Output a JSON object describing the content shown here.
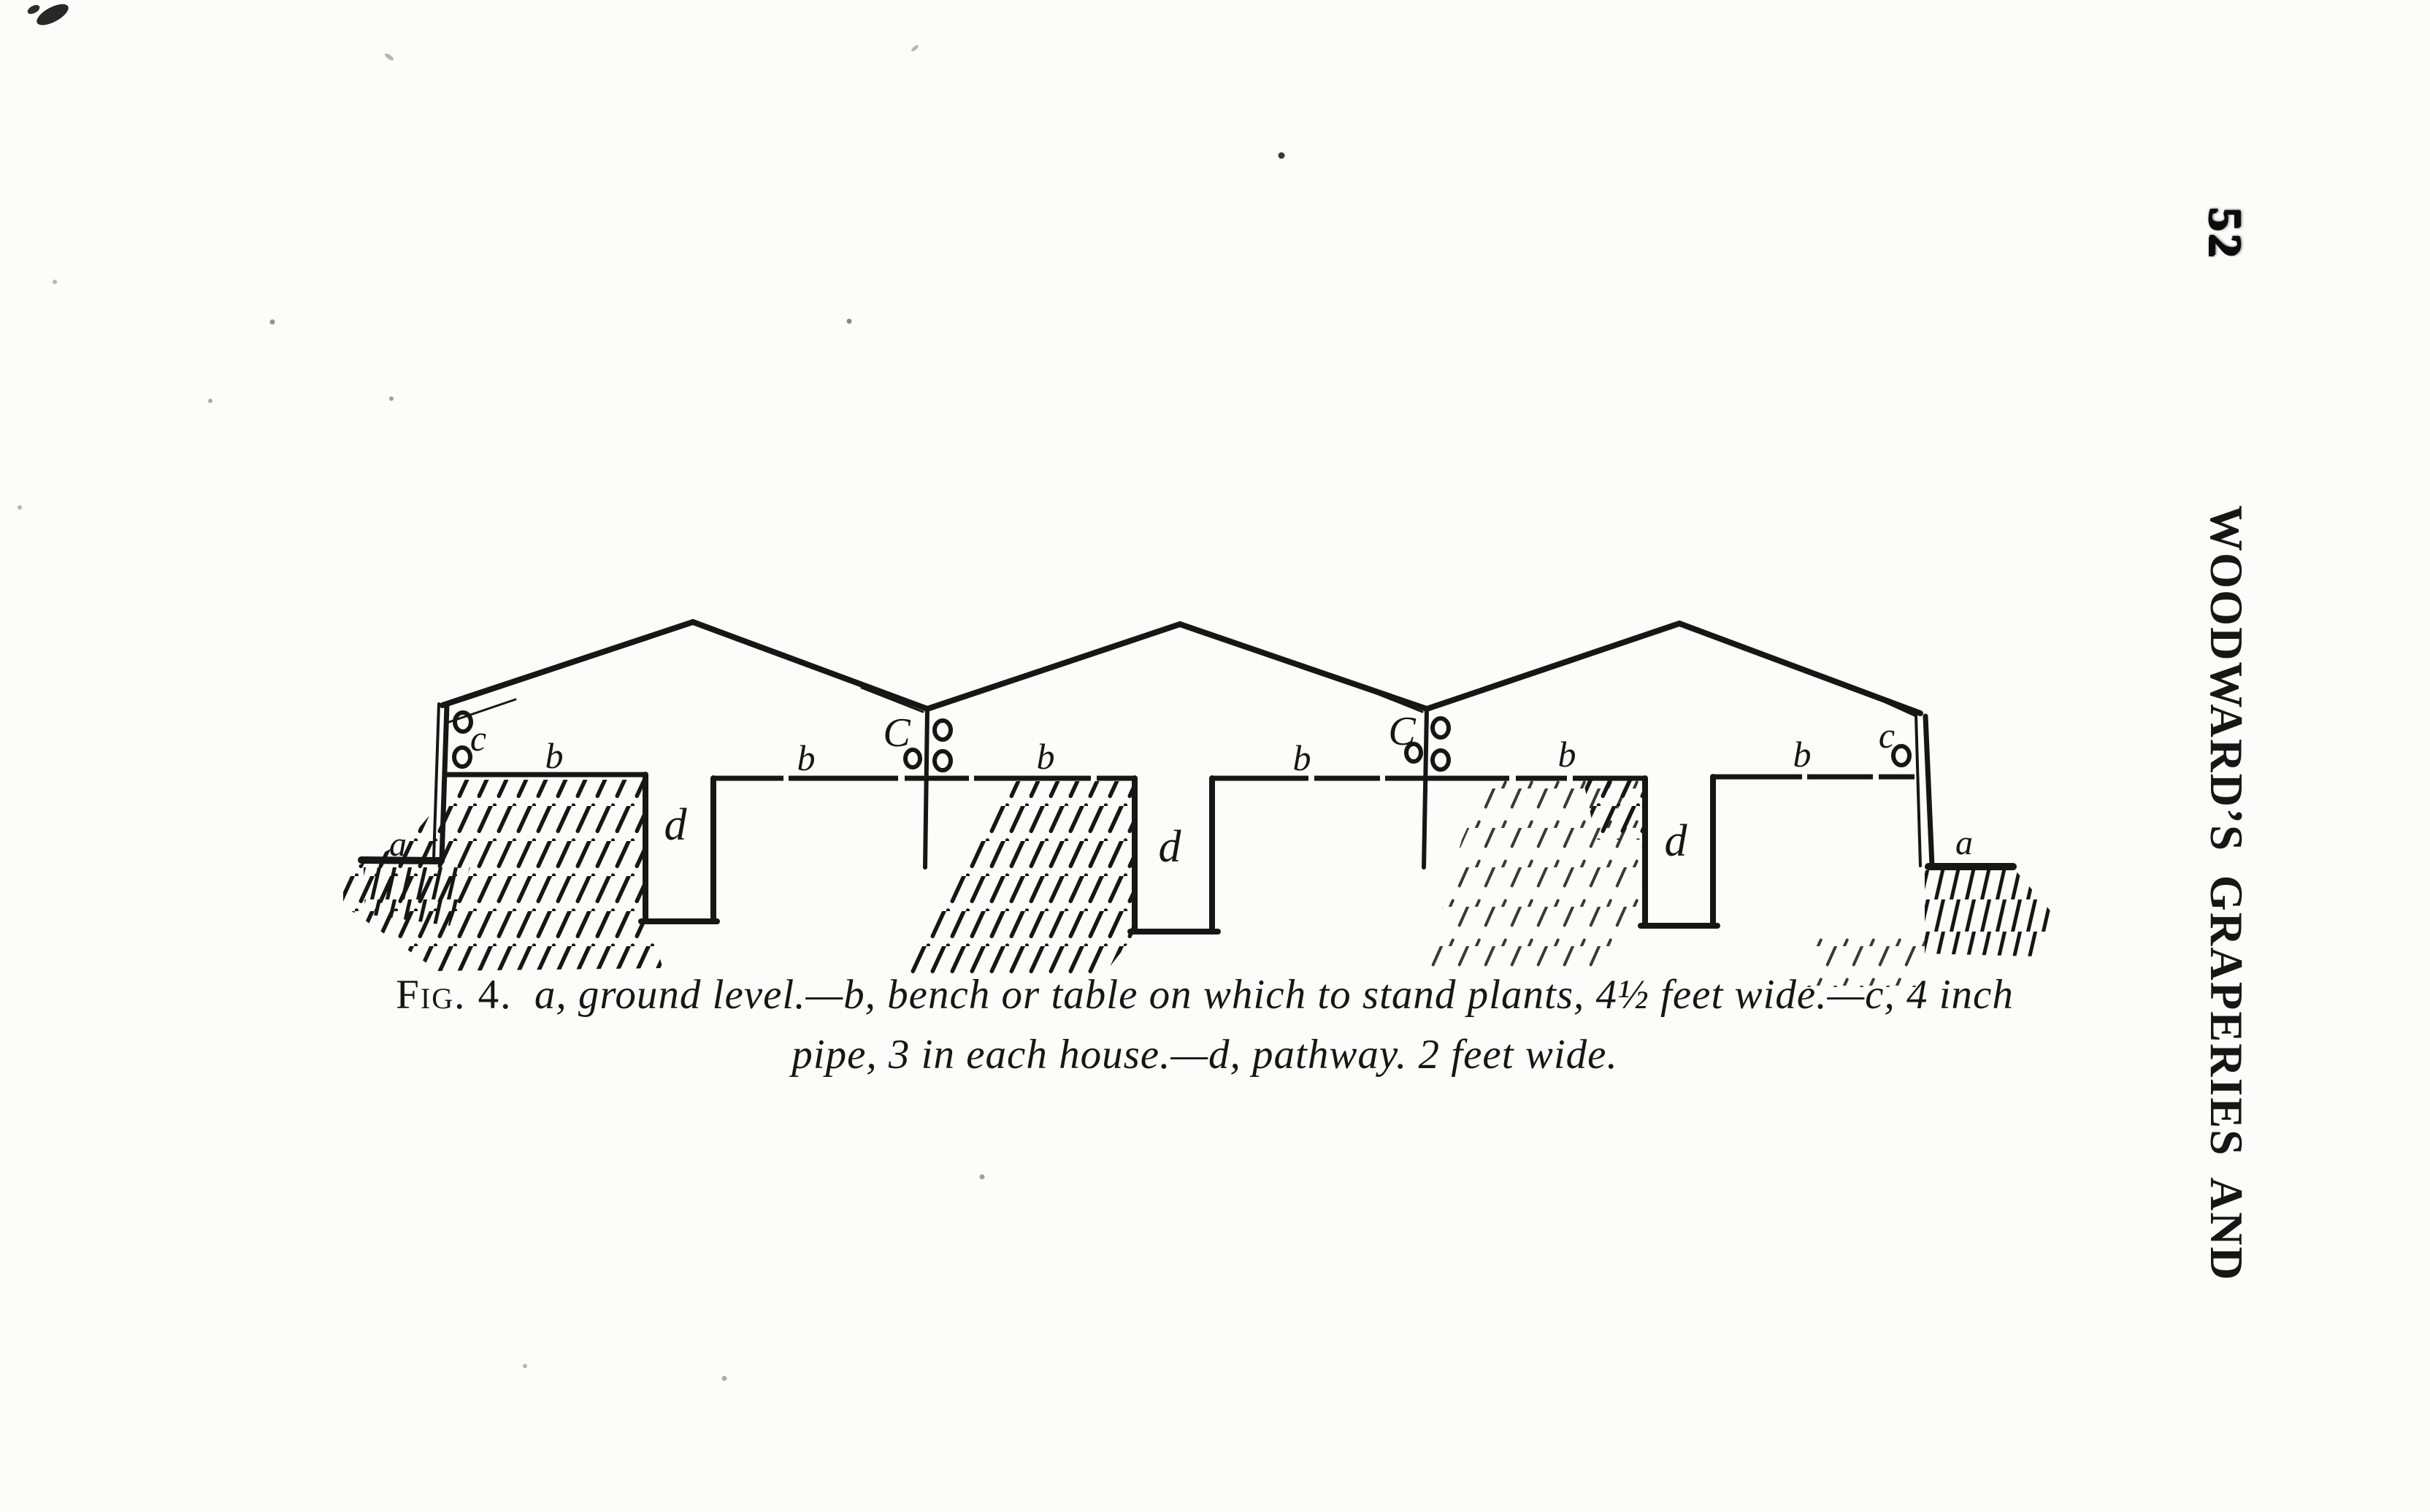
{
  "page": {
    "number": "52",
    "running_head": "WOODWARD’S GRAPERIES AND"
  },
  "figure": {
    "labels": {
      "ground": "a",
      "bench": "b",
      "pipe": "c",
      "pipe_cap": "C",
      "pathway": "d"
    },
    "caption": {
      "fig_label": "Fig. 4.",
      "line1": "a, ground level.—b, bench or table on which to stand plants, 4½ feet wide.—c, 4 inch",
      "line2": "pipe, 3 in each house.—d, pathway. 2 feet wide."
    }
  },
  "colors": {
    "ink": "#161616",
    "paper": "#fcfcfb"
  }
}
